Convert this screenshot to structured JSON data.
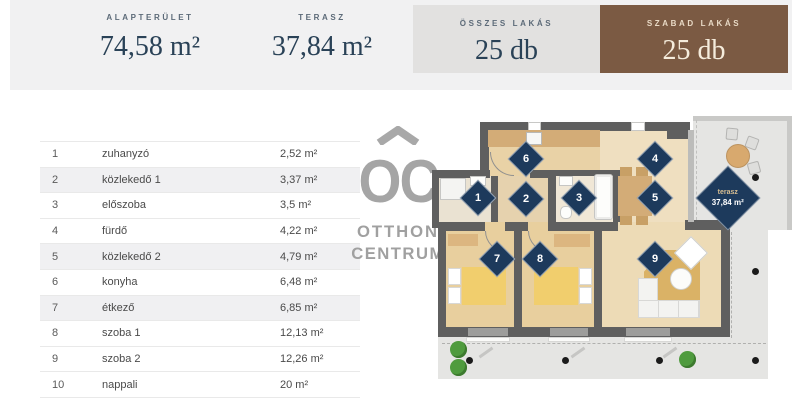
{
  "header": {
    "stats": [
      {
        "label": "ALAPTERÜLET",
        "value": "74,58 m²"
      },
      {
        "label": "TERASZ",
        "value": "37,84 m²"
      },
      {
        "label": "ÖSSZES LAKÁS",
        "value": "25 db"
      },
      {
        "label": "SZABAD LAKÁS",
        "value": "25 db"
      }
    ],
    "colors": {
      "band": "#f1f1f2",
      "gray_box": "#e2e1e0",
      "brown_box": "#7b5a43",
      "navy_text": "#2a4257",
      "diamond_navy": "#1d3a5c"
    }
  },
  "room_table": {
    "rows": [
      {
        "num": "1",
        "name": "zuhanyzó",
        "area": "2,52 m²",
        "shaded": false
      },
      {
        "num": "2",
        "name": "közlekedő 1",
        "area": "3,37 m²",
        "shaded": true
      },
      {
        "num": "3",
        "name": "előszoba",
        "area": "3,5 m²",
        "shaded": false
      },
      {
        "num": "4",
        "name": "fürdő",
        "area": "4,22 m²",
        "shaded": false
      },
      {
        "num": "5",
        "name": "közlekedő 2",
        "area": "4,79 m²",
        "shaded": true
      },
      {
        "num": "6",
        "name": "konyha",
        "area": "6,48 m²",
        "shaded": false
      },
      {
        "num": "7",
        "name": "étkező",
        "area": "6,85 m²",
        "shaded": true
      },
      {
        "num": "8",
        "name": "szoba 1",
        "area": "12,13 m²",
        "shaded": false
      },
      {
        "num": "9",
        "name": "szoba 2",
        "area": "12,26 m²",
        "shaded": false
      },
      {
        "num": "10",
        "name": "nappali",
        "area": "20 m²",
        "shaded": false
      }
    ]
  },
  "watermark": {
    "initials": "OC",
    "line1": "OTTHON",
    "line2": "CENTRUM"
  },
  "floorplan": {
    "markers": [
      "1",
      "2",
      "3",
      "4",
      "5",
      "6",
      "7",
      "8",
      "9"
    ],
    "terrace_diamond": {
      "label": "terasz",
      "value": "37,84 m²"
    }
  }
}
